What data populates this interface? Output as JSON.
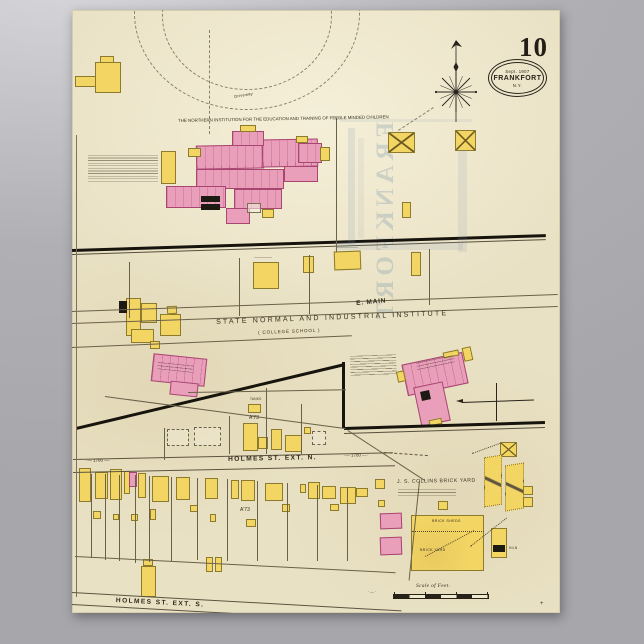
{
  "poster": {
    "sheet_number": "10",
    "stamp": {
      "date": "Sept. 1907",
      "city": "FRANKFORT",
      "state": "N.Y."
    },
    "ghost_text": "FRANKFORT"
  },
  "labels": [
    [
      "institution-title",
      "THE NORTHERN INSTITUTION FOR THE EDUCATION AND TRAINING OF FEEBLE MINDED CHILDREN",
      178,
      119,
      4.4,
      -1,
      0,
      ""
    ],
    [
      "driveway-label",
      "Driveway",
      234,
      95,
      4,
      -10,
      0.3,
      ""
    ],
    [
      "state-normal-title",
      "STATE  NORMAL  AND  INDUSTRIAL  INSTITUTE",
      216,
      319,
      7,
      -2.2,
      2.2,
      ""
    ],
    [
      "college-school-sub",
      "( COLLEGE  SCHOOL )",
      258,
      331,
      4.6,
      -2.2,
      0.8,
      ""
    ],
    [
      "e-main-street",
      "E. MAIN",
      356,
      301,
      6.5,
      -5,
      0.8,
      "st"
    ],
    [
      "holmes-ext-n-street",
      "HOLMES   ST.   EXT. N.",
      228,
      457,
      6.6,
      -1.2,
      1.4,
      "st"
    ],
    [
      "block-number-left",
      "·—  1700  —·",
      86,
      459,
      4.4,
      -1,
      0,
      ""
    ],
    [
      "block-number-right",
      "·—  1700  —·",
      344,
      454,
      4.4,
      -2,
      0,
      ""
    ],
    [
      "a73-upper",
      "A'73",
      249,
      416,
      5,
      0,
      0,
      ""
    ],
    [
      "a73-lower",
      "A'73",
      240,
      508,
      5,
      0,
      0,
      ""
    ],
    [
      "brick-yard-title",
      "J. S. COLLINS  BRICK  YARD",
      397,
      480,
      5.2,
      -1,
      0.5,
      ""
    ],
    [
      "brick-sheds-label",
      "BRICK  SHEDS",
      432,
      520,
      3.6,
      0,
      0.4,
      ""
    ],
    [
      "brick-yard-label",
      "BRICK  YARD",
      420,
      549,
      3.6,
      0,
      0.4,
      ""
    ],
    [
      "kiln-label",
      "KILN",
      509,
      547,
      3.4,
      0,
      0.2,
      ""
    ],
    [
      "tanks-label",
      "TANKS",
      250,
      398,
      3.2,
      0,
      0.2,
      ""
    ],
    [
      "scale-label",
      "Scale of Feet.",
      416,
      584,
      5.5,
      0,
      0.3,
      "ser"
    ],
    [
      "scale-dashes",
      "· — ·",
      368,
      591,
      3.6,
      0,
      0,
      ""
    ],
    [
      "holmes-ext-s-street",
      "HOLMES   ST.  EXT. S.",
      116,
      598,
      6.6,
      3,
      1.4,
      "st"
    ],
    [
      "margin-plus",
      "+",
      540,
      601,
      6,
      0,
      0,
      ""
    ]
  ],
  "squiggles": [
    [
      "institution-notes",
      88,
      155,
      70,
      28,
      0,
      2.6
    ],
    [
      "factory-notes",
      350,
      356,
      46,
      20,
      -2,
      2.7
    ],
    [
      "factory-name-lines",
      416,
      363,
      38,
      8,
      -12,
      3.2
    ],
    [
      "normal-school-name-lines",
      158,
      362,
      36,
      7,
      6,
      3.2
    ],
    [
      "brick-yard-notes",
      398,
      489,
      58,
      8,
      0,
      3.2
    ],
    [
      "building-label-lines-a",
      336,
      247,
      22,
      3,
      0,
      3
    ],
    [
      "building-label-lines-b",
      254,
      257,
      18,
      3,
      0,
      3
    ]
  ],
  "buildings": [
    [
      "y",
      95,
      62,
      26,
      31,
      0,
      ""
    ],
    [
      "y",
      100,
      56,
      14,
      7,
      0,
      ""
    ],
    [
      "y",
      75,
      76,
      21,
      11,
      0,
      ""
    ],
    [
      "p",
      196,
      145,
      68,
      24,
      -1,
      "rooms"
    ],
    [
      "p",
      262,
      139,
      56,
      28,
      -1,
      "rooms"
    ],
    [
      "p",
      232,
      131,
      32,
      15,
      0,
      "rooms"
    ],
    [
      "p",
      196,
      169,
      88,
      20,
      0,
      "rooms"
    ],
    [
      "p",
      166,
      186,
      60,
      22,
      0,
      "rooms"
    ],
    [
      "p",
      234,
      189,
      48,
      20,
      0,
      "rooms"
    ],
    [
      "p",
      226,
      208,
      24,
      16,
      0,
      ""
    ],
    [
      "p",
      298,
      143,
      24,
      20,
      0,
      "rooms"
    ],
    [
      "p",
      284,
      166,
      34,
      16,
      0,
      ""
    ],
    [
      "y",
      161,
      151,
      15,
      33,
      0,
      ""
    ],
    [
      "y",
      188,
      148,
      13,
      9,
      0,
      ""
    ],
    [
      "y",
      240,
      125,
      16,
      7,
      0,
      ""
    ],
    [
      "y",
      296,
      136,
      12,
      7,
      0,
      ""
    ],
    [
      "y",
      320,
      147,
      10,
      14,
      0,
      ""
    ],
    [
      "y",
      262,
      209,
      12,
      9,
      0,
      ""
    ],
    [
      "b",
      201,
      196,
      19,
      6,
      0,
      ""
    ],
    [
      "b",
      201,
      204,
      19,
      6,
      0,
      ""
    ],
    [
      "o",
      247,
      203,
      14,
      10,
      0,
      ""
    ],
    [
      "y",
      388,
      132,
      27,
      21,
      0,
      "xbarn"
    ],
    [
      "y",
      455,
      130,
      21,
      21,
      0,
      "xbarn"
    ],
    [
      "y",
      253,
      262,
      26,
      27,
      0,
      ""
    ],
    [
      "y",
      303,
      256,
      11,
      17,
      0,
      ""
    ],
    [
      "y",
      334,
      251,
      27,
      19,
      -2,
      ""
    ],
    [
      "y",
      411,
      252,
      10,
      24,
      0,
      ""
    ],
    [
      "y",
      402,
      202,
      9,
      16,
      0,
      ""
    ],
    [
      "y",
      126,
      298,
      15,
      38,
      0,
      ""
    ],
    [
      "y",
      141,
      303,
      16,
      20,
      0,
      ""
    ],
    [
      "y",
      131,
      329,
      23,
      14,
      0,
      ""
    ],
    [
      "b",
      119,
      301,
      8,
      12,
      0,
      ""
    ],
    [
      "y",
      160,
      314,
      21,
      22,
      0,
      ""
    ],
    [
      "y",
      167,
      306,
      10,
      8,
      -3,
      ""
    ],
    [
      "y",
      150,
      341,
      10,
      8,
      0,
      ""
    ],
    [
      "p",
      152,
      356,
      54,
      28,
      6,
      "rooms"
    ],
    [
      "p",
      170,
      382,
      28,
      14,
      6,
      ""
    ],
    [
      "p",
      404,
      358,
      62,
      32,
      -12,
      "rooms"
    ],
    [
      "p",
      417,
      384,
      30,
      40,
      -12,
      ""
    ],
    [
      "y",
      397,
      371,
      8,
      11,
      -12,
      ""
    ],
    [
      "y",
      463,
      347,
      9,
      14,
      -12,
      ""
    ],
    [
      "y",
      443,
      351,
      16,
      6,
      -12,
      ""
    ],
    [
      "b",
      421,
      391,
      9,
      9,
      -12,
      ""
    ],
    [
      "y",
      429,
      419,
      13,
      6,
      -12,
      ""
    ],
    [
      "d",
      167,
      429,
      22,
      17,
      0,
      ""
    ],
    [
      "d",
      194,
      427,
      27,
      19,
      0,
      ""
    ],
    [
      "d",
      312,
      431,
      14,
      14,
      0,
      ""
    ],
    [
      "y",
      243,
      423,
      15,
      28,
      0,
      ""
    ],
    [
      "y",
      258,
      437,
      10,
      12,
      0,
      ""
    ],
    [
      "y",
      271,
      429,
      11,
      21,
      0,
      ""
    ],
    [
      "y",
      285,
      435,
      17,
      17,
      0,
      ""
    ],
    [
      "y",
      304,
      427,
      7,
      7,
      0,
      ""
    ],
    [
      "y",
      248,
      404,
      13,
      9,
      0,
      ""
    ],
    [
      "y",
      500,
      442,
      17,
      15,
      0,
      "xbarn"
    ],
    [
      "y",
      79,
      468,
      12,
      34,
      0,
      ""
    ],
    [
      "y",
      95,
      472,
      13,
      27,
      0,
      ""
    ],
    [
      "y",
      110,
      469,
      12,
      31,
      0,
      ""
    ],
    [
      "y",
      124,
      471,
      6,
      23,
      0,
      ""
    ],
    [
      "p",
      129,
      472,
      8,
      15,
      0,
      ""
    ],
    [
      "y",
      138,
      473,
      8,
      25,
      0,
      ""
    ],
    [
      "y",
      152,
      476,
      17,
      26,
      0,
      ""
    ],
    [
      "y",
      176,
      477,
      14,
      23,
      0,
      ""
    ],
    [
      "y",
      205,
      478,
      13,
      21,
      0,
      ""
    ],
    [
      "y",
      231,
      480,
      8,
      19,
      0,
      ""
    ],
    [
      "y",
      241,
      480,
      14,
      21,
      0,
      ""
    ],
    [
      "y",
      265,
      483,
      18,
      18,
      0,
      ""
    ],
    [
      "y",
      300,
      484,
      6,
      9,
      0,
      ""
    ],
    [
      "y",
      308,
      482,
      12,
      17,
      0,
      ""
    ],
    [
      "y",
      322,
      486,
      14,
      13,
      0,
      ""
    ],
    [
      "y",
      340,
      487,
      16,
      17,
      0,
      ""
    ],
    [
      "y",
      356,
      488,
      12,
      9,
      0,
      ""
    ],
    [
      "y",
      375,
      479,
      10,
      10,
      0,
      ""
    ],
    [
      "y",
      93,
      511,
      8,
      8,
      0,
      ""
    ],
    [
      "y",
      113,
      514,
      6,
      6,
      0,
      ""
    ],
    [
      "y",
      131,
      514,
      7,
      7,
      0,
      ""
    ],
    [
      "y",
      150,
      509,
      6,
      11,
      0,
      ""
    ],
    [
      "y",
      190,
      505,
      8,
      7,
      0,
      ""
    ],
    [
      "y",
      210,
      514,
      6,
      8,
      0,
      ""
    ],
    [
      "y",
      246,
      519,
      10,
      8,
      0,
      ""
    ],
    [
      "y",
      282,
      504,
      8,
      8,
      0,
      ""
    ],
    [
      "y",
      330,
      504,
      9,
      7,
      0,
      ""
    ],
    [
      "y",
      378,
      500,
      7,
      7,
      0,
      ""
    ],
    [
      "y",
      206,
      557,
      7,
      15,
      0,
      ""
    ],
    [
      "y",
      215,
      557,
      7,
      15,
      0,
      ""
    ],
    [
      "y",
      143,
      559,
      10,
      7,
      0,
      ""
    ],
    [
      "y",
      141,
      566,
      15,
      31,
      0,
      ""
    ],
    [
      "p",
      380,
      513,
      22,
      16,
      -2,
      ""
    ],
    [
      "p",
      380,
      537,
      22,
      18,
      -2,
      ""
    ],
    [
      "y",
      438,
      501,
      10,
      9,
      0,
      ""
    ],
    [
      "y",
      484,
      456,
      18,
      50,
      0,
      "shed"
    ],
    [
      "y",
      505,
      464,
      19,
      46,
      0,
      "shed"
    ],
    [
      "y",
      411,
      515,
      73,
      56,
      0,
      "yard"
    ],
    [
      "y",
      491,
      528,
      16,
      30,
      0,
      ""
    ],
    [
      "b",
      493,
      545,
      12,
      7,
      0,
      ""
    ],
    [
      "y",
      523,
      486,
      10,
      9,
      0,
      ""
    ],
    [
      "y",
      523,
      497,
      10,
      10,
      0,
      ""
    ]
  ],
  "lines": [
    [
      72,
      249,
      474,
      -1.8,
      2.6,
      "solid",
      "#17130d"
    ],
    [
      72,
      254,
      474,
      -1.8,
      0.7,
      "solid",
      "#57503c"
    ],
    [
      72,
      311,
      486,
      -2.0,
      0.8,
      "solid",
      "#6a6149"
    ],
    [
      72,
      323,
      486,
      -2.0,
      0.8,
      "solid",
      "#6a6149"
    ],
    [
      72,
      347,
      280,
      -2.4,
      0.7,
      "solid",
      "#6a6149"
    ],
    [
      76,
      427,
      276,
      -13.4,
      2.6,
      "solid",
      "#17130d"
    ],
    [
      345,
      362,
      66,
      90,
      2.6,
      "solid",
      "#17130d"
    ],
    [
      344,
      427,
      201,
      -1.7,
      2.6,
      "solid",
      "#17130d"
    ],
    [
      344,
      433,
      201,
      -1.7,
      0.7,
      "solid",
      "#57503c"
    ],
    [
      105,
      396,
      243,
      7.6,
      0.7,
      "solid",
      "#6a6149"
    ],
    [
      348,
      430,
      92,
      33,
      0.7,
      "solid",
      "#6a6149"
    ],
    [
      420,
      481,
      100,
      96,
      0.7,
      "solid",
      "#6a6149"
    ],
    [
      73,
      459,
      320,
      -1.2,
      0.8,
      "solid",
      "#5d5440"
    ],
    [
      73,
      472,
      322,
      -1.2,
      0.8,
      "solid",
      "#5d5440"
    ],
    [
      384,
      452,
      44,
      4,
      0.8,
      "dashed",
      "#5d5440"
    ],
    [
      130,
      262,
      56,
      90,
      0.6,
      "solid",
      "#6a6149"
    ],
    [
      240,
      258,
      58,
      90,
      0.6,
      "solid",
      "#6a6149"
    ],
    [
      310,
      255,
      59,
      90,
      0.6,
      "solid",
      "#6a6149"
    ],
    [
      430,
      249,
      56,
      90,
      0.6,
      "solid",
      "#6a6149"
    ],
    [
      337,
      118,
      134,
      90,
      0.6,
      "solid",
      "#6a6149"
    ],
    [
      210,
      30,
      104,
      90,
      0.7,
      "dashed",
      "#8a8066"
    ],
    [
      230,
      416,
      38,
      90,
      0.6,
      "solid",
      "#6a6149"
    ],
    [
      267,
      388,
      66,
      90,
      0.6,
      "solid",
      "#6a6149"
    ],
    [
      302,
      404,
      50,
      90,
      0.6,
      "solid",
      "#6a6149"
    ],
    [
      165,
      428,
      32,
      90,
      0.6,
      "solid",
      "#6a6149"
    ],
    [
      188,
      392,
      158,
      -1,
      0.6,
      "solid",
      "#6a6149"
    ],
    [
      77,
      135,
      462,
      90,
      0.6,
      "solid",
      "#7b7258"
    ],
    [
      92,
      474,
      84,
      90,
      0.55,
      "solid",
      "#6a6149"
    ],
    [
      106,
      474,
      86,
      90,
      0.55,
      "solid",
      "#6a6149"
    ],
    [
      120,
      475,
      86,
      90,
      0.55,
      "solid",
      "#6a6149"
    ],
    [
      136,
      475,
      88,
      90,
      0.55,
      "solid",
      "#6a6149"
    ],
    [
      150,
      476,
      86,
      90,
      0.55,
      "solid",
      "#6a6149"
    ],
    [
      172,
      477,
      84,
      90,
      0.55,
      "solid",
      "#6a6149"
    ],
    [
      198,
      478,
      82,
      90,
      0.55,
      "solid",
      "#6a6149"
    ],
    [
      228,
      479,
      82,
      90,
      0.55,
      "solid",
      "#6a6149"
    ],
    [
      258,
      481,
      80,
      90,
      0.55,
      "solid",
      "#6a6149"
    ],
    [
      288,
      483,
      78,
      90,
      0.55,
      "solid",
      "#6a6149"
    ],
    [
      318,
      485,
      76,
      90,
      0.55,
      "solid",
      "#6a6149"
    ],
    [
      348,
      487,
      74,
      90,
      0.55,
      "solid",
      "#6a6149"
    ],
    [
      75,
      556,
      321,
      2.9,
      0.7,
      "solid",
      "#6a6149"
    ],
    [
      72,
      592,
      330,
      3.2,
      0.8,
      "solid",
      "#5d5440"
    ],
    [
      72,
      604,
      330,
      3.2,
      0.8,
      "solid",
      "#5d5440"
    ],
    [
      470,
      546,
      46,
      -38,
      0.8,
      "dotted",
      "#56492a"
    ],
    [
      472,
      453,
      30,
      -20,
      0.8,
      "dotted",
      "#56492a"
    ],
    [
      425,
      556,
      55,
      -28,
      0.7,
      "dotted",
      "#56492a"
    ],
    [
      412,
      531,
      72,
      0,
      0.8,
      "dotted",
      "#56492a"
    ],
    [
      462,
      402,
      72,
      -2,
      0.8,
      "solid",
      "#2a241a"
    ],
    [
      497,
      383,
      38,
      90,
      0.8,
      "solid",
      "#2a241a"
    ],
    [
      398,
      130,
      42,
      -33,
      0.7,
      "dashed",
      "#8a8066"
    ]
  ],
  "ghost_bands": [
    [
      348,
      128,
      7,
      118,
      0.16
    ],
    [
      458,
      150,
      9,
      102,
      0.14
    ],
    [
      335,
      242,
      128,
      8,
      0.15
    ],
    [
      340,
      119,
      132,
      3,
      0.12
    ],
    [
      358,
      138,
      6,
      100,
      0.1
    ]
  ],
  "arcs": [
    [
      60,
      -94,
      224,
      192
    ],
    [
      88,
      -68,
      168,
      146
    ]
  ]
}
